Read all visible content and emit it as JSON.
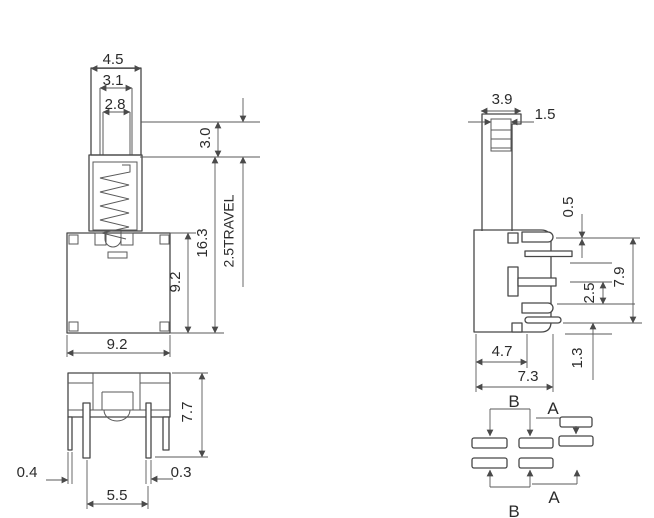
{
  "drawing": {
    "front_view": {
      "cap_width": "4.5",
      "cap_step_width": "3.1",
      "cap_bore_width": "2.8",
      "cap_height": "3.0",
      "overall_height": "16.3",
      "body_height": "9.2",
      "body_width": "9.2",
      "travel": "2.5TRAVEL"
    },
    "bottom_view": {
      "height": "7.7",
      "leg_width": "0.4",
      "pin_width": "0.3",
      "pin_spacing": "5.5"
    },
    "side_view": {
      "stem_width": "3.9",
      "stem_tip_width": "1.5",
      "terminal_offset": "0.5",
      "terminal_pitch": "2.5",
      "body_height": "7.9",
      "bottom_clearance": "1.3",
      "inner_width": "4.7",
      "body_width": "7.3"
    },
    "terminal_diagram": {
      "top_group_label": "B",
      "top_right_label": "A",
      "bottom_group_label": "B",
      "bottom_right_label": "A"
    }
  }
}
